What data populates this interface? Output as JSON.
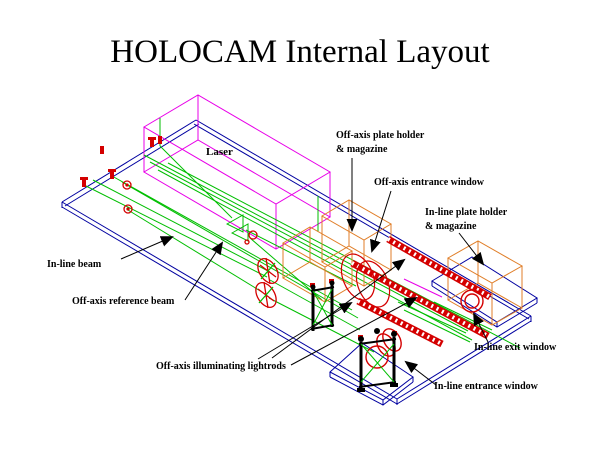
{
  "title": "HOLOCAM Internal Layout",
  "diagram": {
    "labels": {
      "laser": "Laser",
      "off_axis_plate_holder_l1": "Off-axis plate holder",
      "off_axis_plate_holder_l2": "& magazine",
      "off_axis_entrance_window": "Off-axis entrance window",
      "in_line_plate_holder_l1": "In-line plate holder",
      "in_line_plate_holder_l2": "& magazine",
      "in_line_beam": "In-line beam",
      "off_axis_reference_beam": "Off-axis reference beam",
      "off_axis_illuminating_lightrods": "Off-axis illuminating lightrods",
      "in_line_exit_window": "In-line exit window",
      "in_line_entrance_window": "In-line entrance window"
    },
    "colors": {
      "background": "#FFFFFF",
      "laser_box_magenta": "#E800E8",
      "baseplate_blue": "#0000A0",
      "beam_green": "#00BE00",
      "component_red": "#D40000",
      "plate_holder_orange": "#E07E28",
      "annotation_black": "#000000"
    }
  }
}
